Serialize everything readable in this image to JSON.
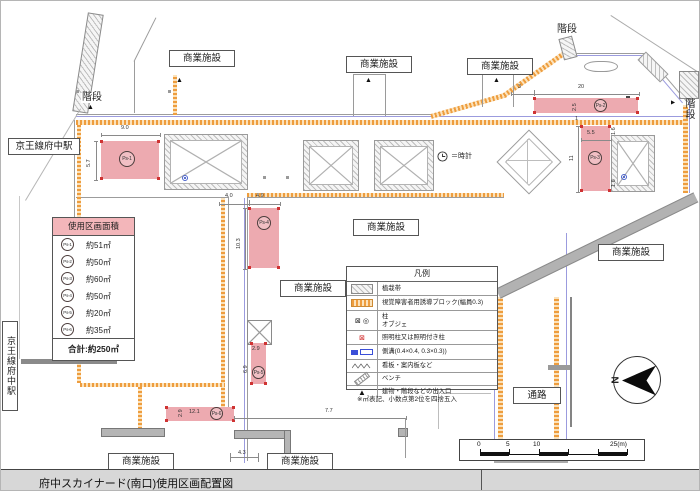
{
  "colors": {
    "parcel": "#edaab0",
    "parcel_header": "#f3b6ba",
    "tactile": "#ee9d3e",
    "gutter_line": "#9b9bde",
    "accent_red": "#cf3333"
  },
  "labels": {
    "station": "京王線府中駅",
    "stairs": "階段",
    "commercial": "商業施設",
    "passage": "通路",
    "clock_note": "＝時計",
    "north": "N"
  },
  "area_table": {
    "title": "使用区画面積",
    "rows": [
      {
        "id": "Ps-1",
        "area": "約51㎡"
      },
      {
        "id": "Ps-2",
        "area": "約50㎡"
      },
      {
        "id": "Ps-3",
        "area": "約60㎡"
      },
      {
        "id": "Ps-4",
        "area": "約50㎡"
      },
      {
        "id": "Ps-5",
        "area": "約20㎡"
      },
      {
        "id": "Ps-6",
        "area": "約35㎡"
      }
    ],
    "total": "合計:約250㎡"
  },
  "legend": {
    "title": "凡例",
    "items": [
      {
        "label": "植栽帯"
      },
      {
        "label": "視覚障害者用誘導ブロック(幅員0.3)"
      },
      {
        "label": "柱",
        "label2": "オブジェ"
      },
      {
        "label": "照明柱又は照明付き柱"
      },
      {
        "label": "側溝(0.4×0.4, 0.3×0.3))"
      },
      {
        "label": "看板・案内板など"
      },
      {
        "label": "ベンチ"
      },
      {
        "label": "建物・階段などの出入口"
      }
    ],
    "note": "※㎡表記、小数点第2位を四捨五入"
  },
  "parcels": {
    "p1": {
      "id": "Ps-1",
      "w": "9.0",
      "h": "5.7"
    },
    "p2": {
      "id": "Ps-2",
      "offset": "3",
      "w": "20",
      "h": "2.5",
      "gap": "1"
    },
    "p3": {
      "id": "Ps-3",
      "w": "5.5",
      "h": "11",
      "top": "1.6",
      "bottom": "1.6"
    },
    "p4": {
      "id": "Ps-4",
      "offset": "4.0",
      "w": "4.9",
      "h": "10.3"
    },
    "p5": {
      "id": "Ps-5",
      "w": "2.9",
      "h": "6.9"
    },
    "p6": {
      "id": "Ps-6",
      "h": "2.9",
      "w": "12.1",
      "right": "7.7",
      "below": "4.3"
    }
  },
  "scale_bar": {
    "ticks": [
      "0",
      "5",
      "10",
      "25(m)"
    ]
  },
  "footer": {
    "title": "府中スカイナード(南口)使用区画配置図"
  }
}
